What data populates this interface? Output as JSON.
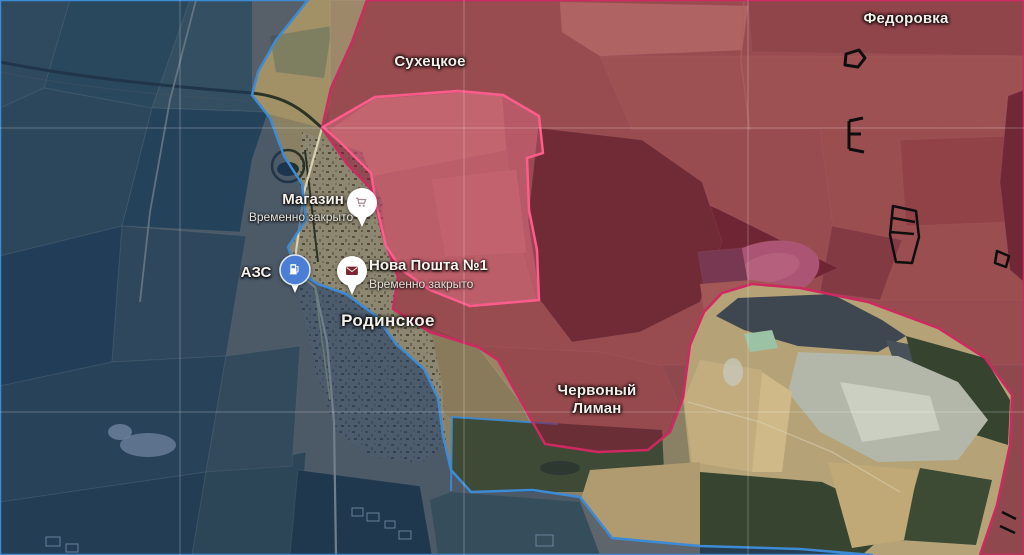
{
  "map": {
    "place_labels": [
      {
        "text": "Сухецкое"
      },
      {
        "text": "Федоровка"
      },
      {
        "text": "Родинское"
      },
      {
        "text": "Червоный Лиман"
      }
    ],
    "pois": [
      {
        "name": "Магазин",
        "status": "Временно закрыто",
        "icon": "shopping-cart-icon",
        "pin_color": "#ffffff",
        "glyph_color": "#a98b94"
      },
      {
        "name": "АЗС",
        "icon": "fuel-pump-icon",
        "pin_color": "#4b7ed4",
        "glyph_color": "#ffffff"
      },
      {
        "name": "Нова Пошта №1",
        "status": "Временно закрыто",
        "icon": "envelope-icon",
        "pin_color": "#ffffff",
        "glyph_color": "#7d2430"
      }
    ],
    "zones": {
      "blue_zone": {
        "fill": "rgba(24,56,106,0.54)",
        "border": "#3d8bd4"
      },
      "red_zone": {
        "fill": "rgba(148,22,58,0.52)",
        "border": "#ce2960"
      },
      "claimed_zone": {
        "fill": "rgba(255,118,158,0.30)",
        "border": "#ff5c8c"
      }
    }
  }
}
